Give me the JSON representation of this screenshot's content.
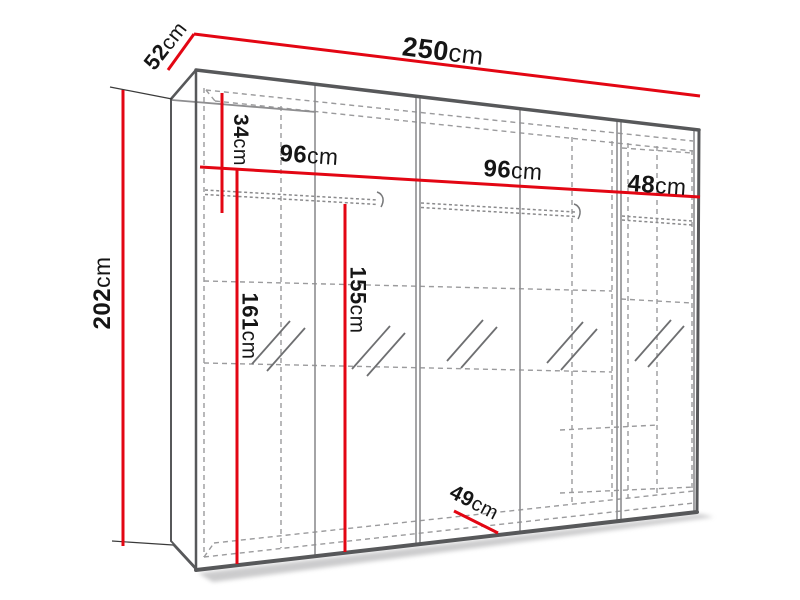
{
  "diagram": {
    "title": "wardrobe-dimension-diagram",
    "colors": {
      "dimension_line": "#e30613",
      "edge": "#57585a",
      "hidden_line": "#9b9b9d",
      "text": "#151515",
      "background": "#ffffff"
    },
    "dimensions": {
      "width_total": {
        "value": "250",
        "unit": "cm"
      },
      "depth_top": {
        "value": "52",
        "unit": "cm"
      },
      "height_total": {
        "value": "202",
        "unit": "cm"
      },
      "top_shelf_height": {
        "value": "34",
        "unit": "cm"
      },
      "section_left_width": {
        "value": "96",
        "unit": "cm"
      },
      "section_mid_width": {
        "value": "96",
        "unit": "cm"
      },
      "section_right_width": {
        "value": "48",
        "unit": "cm"
      },
      "hanging_height_1": {
        "value": "161",
        "unit": "cm"
      },
      "hanging_height_2": {
        "value": "155",
        "unit": "cm"
      },
      "depth_bottom": {
        "value": "49",
        "unit": "cm"
      }
    }
  }
}
